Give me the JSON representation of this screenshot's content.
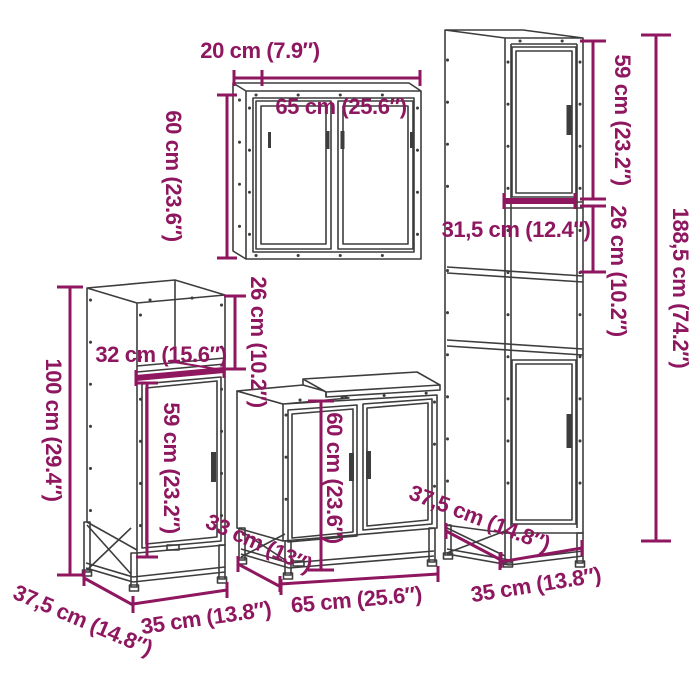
{
  "colors": {
    "dimension": "#8E175F",
    "furniture": "#3D3D3D",
    "background": "#FFFFFF"
  },
  "diagram": {
    "description": "4-piece bathroom furniture set dimension drawing",
    "pieces": [
      "wall-mirror-cabinet",
      "tall-cabinet",
      "side-cabinet",
      "sink-cabinet"
    ]
  },
  "dimensions": {
    "wall_cabinet": {
      "depth": "20 cm (7.9″)",
      "width": "65 cm (25.6″)",
      "height": "60 cm (23.6″)"
    },
    "tall_cabinet": {
      "upper_door_height": "59 cm (23.2″)",
      "compartment_height": "26 cm (10.2″)",
      "inner_width": "31,5 cm (12.4″)",
      "total_height": "188,5 cm (74.2″)",
      "depth": "37,5 cm (14.8″)",
      "width": "35 cm (13.8″)"
    },
    "side_cabinet": {
      "top_width": "32 cm (15.6″)",
      "total_height": "100 cm (29.4″)",
      "door_height": "59 cm (23.2″)",
      "compartment_height": "26 cm (10.2″)",
      "depth": "37,5 cm (14.8″)",
      "width": "35 cm (13.8″)"
    },
    "sink_cabinet": {
      "height": "60 cm (23.6″)",
      "depth": "33 cm (13″)",
      "depth_right": "37,5 cm (14.8″)",
      "width": "65 cm (25.6″)"
    }
  }
}
